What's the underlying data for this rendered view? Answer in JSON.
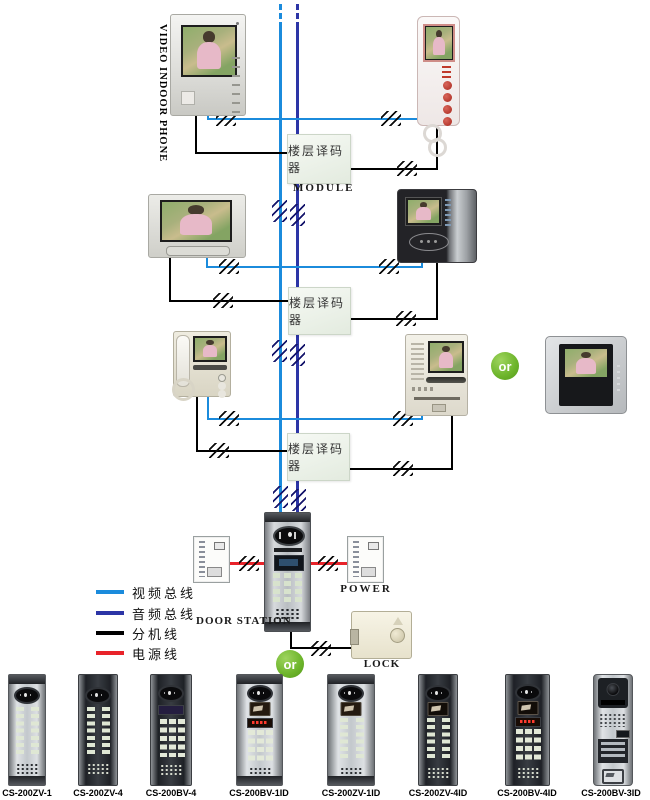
{
  "diagram": {
    "vertical_title": "VIDEO INDOOR PHONE",
    "module_box_label": "楼层译码器",
    "module_caption": "MODULE",
    "door_station_label": "DOOR STATION",
    "power_label": "POWER",
    "lock_label": "LOCK",
    "or_label": "or"
  },
  "colors": {
    "video_bus": "#1b8bdc",
    "audio_bus": "#2c35a6",
    "extension_line": "#000000",
    "power_line": "#e8232a",
    "or_badge": "#6cb42a"
  },
  "legend": {
    "items": [
      {
        "name": "video-bus",
        "label": "视频总线",
        "color": "#1b8bdc"
      },
      {
        "name": "audio-bus",
        "label": "音频总线",
        "color": "#2c35a6"
      },
      {
        "name": "extension-line",
        "label": "分机线",
        "color": "#000000"
      },
      {
        "name": "power-line",
        "label": "电源线",
        "color": "#e8232a"
      }
    ]
  },
  "products": [
    {
      "model": "CS-200ZV-1"
    },
    {
      "model": "CS-200ZV-4"
    },
    {
      "model": "CS-200BV-4"
    },
    {
      "model": "CS-200BV-1ID"
    },
    {
      "model": "CS-200ZV-1ID"
    },
    {
      "model": "CS-200ZV-4ID"
    },
    {
      "model": "CS-200BV-4ID"
    },
    {
      "model": "CS-200BV-3ID"
    }
  ]
}
